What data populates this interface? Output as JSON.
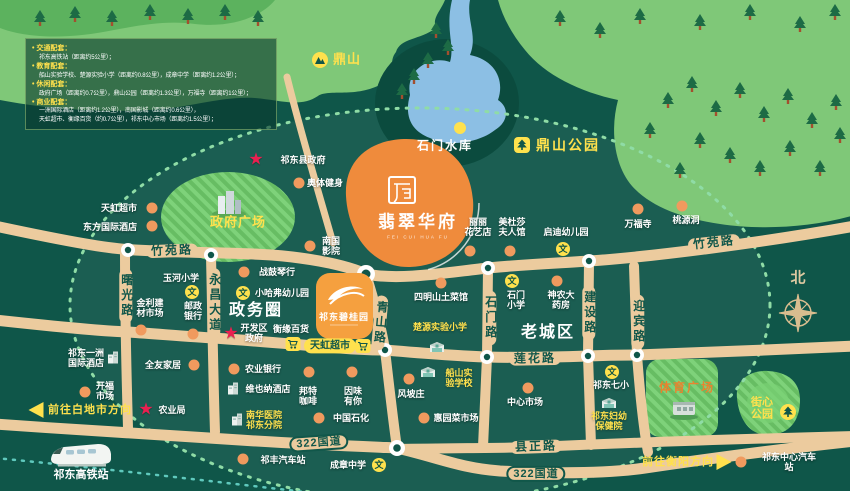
{
  "project": {
    "name": "翡翠华府",
    "pinyin": "FEI CUI HUA FU"
  },
  "compass": {
    "label": "北"
  },
  "colors": {
    "background": "#0f5649",
    "hill": "#7fc878",
    "road": "#eccb9e",
    "water": "#8cbfe4",
    "project_blob": "#ef8b3c",
    "brand_box": "#f5a03f",
    "accent_yellow": "#ffe14d",
    "star_red": "#ea2050",
    "poi_dot": "#f09a5e"
  },
  "legend": {
    "lines": [
      {
        "type": "h",
        "text": "交通配套："
      },
      {
        "type": "i",
        "text": "祁东高铁站（距离约5公里）；"
      },
      {
        "type": "h",
        "text": "教育配套："
      },
      {
        "type": "i",
        "text": "船山实验学校、楚源实验小学（距离约0.8公里），成章中学（距离约1.2公里）；"
      },
      {
        "type": "h",
        "text": "休闲配套："
      },
      {
        "type": "i",
        "text": "政府广场（距离约0.7公里），鼎山公园（距离约1.3公里），万福寺（距离约1公里）；"
      },
      {
        "type": "h",
        "text": "商业配套："
      },
      {
        "type": "i",
        "text": "一洲国际酒店（距离约1.2公里），南国影城（距离约0.6公里），"
      },
      {
        "type": "i",
        "text": "天虹超市、衡缘百货（约0.7公里），祁东中心市场（距离约1.5公里）；"
      }
    ]
  },
  "icons": {
    "wen_glyph": "文",
    "star_glyph": "★"
  },
  "map_labels": [
    {
      "name": "dingshan-hill",
      "t": "鼎山",
      "x": 347,
      "y": 60,
      "c": "yb13",
      "icon": "mountain",
      "ix": 320,
      "iy": 60
    },
    {
      "name": "shimen-reservoir",
      "t": "石门水库",
      "x": 445,
      "y": 146,
      "c": "wb12",
      "icon": "ydot",
      "ix": 460,
      "iy": 128
    },
    {
      "name": "dingshan-park",
      "t": "鼎山公园",
      "x": 568,
      "y": 146,
      "c": "yb14",
      "icon": "park",
      "ix": 522,
      "iy": 145
    },
    {
      "name": "qidong-county-gov",
      "t": "祁东县政府",
      "x": 303,
      "y": 160,
      "c": "w",
      "icon": "star",
      "ix": 256,
      "iy": 160
    },
    {
      "name": "aoti-fitness",
      "t": "奥体健身",
      "x": 325,
      "y": 183,
      "c": "w",
      "icon": "dot",
      "ix": 299,
      "iy": 183
    },
    {
      "name": "tianhong-market-west",
      "t": "天虹超市",
      "x": 119,
      "y": 208,
      "c": "w",
      "icon": "dot",
      "ix": 152,
      "iy": 208
    },
    {
      "name": "dongfang-intl-hotel",
      "t": "东方国际酒店",
      "x": 110,
      "y": 227,
      "c": "w",
      "icon": "dot",
      "ix": 152,
      "iy": 226
    },
    {
      "name": "zhengfu-square",
      "t": "政府广场",
      "x": 238,
      "y": 223,
      "c": "yb13"
    },
    {
      "name": "wanfu-temple",
      "t": "万福寺",
      "x": 638,
      "y": 224,
      "c": "w",
      "icon": "dot",
      "ix": 638,
      "iy": 209
    },
    {
      "name": "taoyuan-cave",
      "t": "桃源洞",
      "x": 686,
      "y": 220,
      "c": "w",
      "icon": "dot",
      "ix": 682,
      "iy": 206
    },
    {
      "name": "qidi-kindergarten",
      "t": "启迪幼儿园",
      "x": 566,
      "y": 232,
      "c": "w",
      "icon": "wen",
      "ix": 563,
      "iy": 249
    },
    {
      "name": "medusa-hall",
      "t": "美杜莎|夫人馆",
      "x": 512,
      "y": 227,
      "c": "w",
      "icon": "dot",
      "ix": 510,
      "iy": 251
    },
    {
      "name": "lili-flower-shop",
      "t": "丽丽|花艺店",
      "x": 478,
      "y": 227,
      "c": "w",
      "icon": "dot",
      "ix": 470,
      "iy": 251
    },
    {
      "name": "nanguo-cinema",
      "t": "南国|影院",
      "x": 331,
      "y": 246,
      "c": "w",
      "icon": "dot",
      "ix": 310,
      "iy": 246
    },
    {
      "name": "yuhe-primary-school",
      "t": "玉河小学",
      "x": 181,
      "y": 278,
      "c": "w",
      "icon": "wen",
      "ix": 192,
      "iy": 292
    },
    {
      "name": "zhangu-piano-shop",
      "t": "战鼓琴行",
      "x": 277,
      "y": 272,
      "c": "w",
      "icon": "dot",
      "ix": 244,
      "iy": 272
    },
    {
      "name": "harvard-kindergarten",
      "t": "小哈弗幼儿园",
      "x": 282,
      "y": 293,
      "c": "w",
      "icon": "wen",
      "ix": 243,
      "iy": 293
    },
    {
      "name": "zhengwu-circle",
      "t": "政务圈",
      "x": 256,
      "y": 311,
      "c": "big"
    },
    {
      "name": "jinli-materials-market",
      "t": "金利建|材市场",
      "x": 150,
      "y": 308,
      "c": "w",
      "icon": "dot",
      "ix": 141,
      "iy": 330
    },
    {
      "name": "postal-bank",
      "t": "邮政|银行",
      "x": 193,
      "y": 311,
      "c": "w",
      "icon": "dot",
      "ix": 193,
      "iy": 334
    },
    {
      "name": "kaifaqu-gov",
      "t": "开发区|政府",
      "x": 254,
      "y": 333,
      "c": "w",
      "icon": "star",
      "ix": 231,
      "iy": 334
    },
    {
      "name": "hengyuan-store",
      "t": "衡缘百货",
      "x": 291,
      "y": 329,
      "c": "w"
    },
    {
      "name": "tianhong-market-center",
      "t": "天虹超市",
      "x": 330,
      "y": 346,
      "c": "cap-y"
    },
    {
      "name": "cart-icon-left",
      "t": "",
      "icon": "cart",
      "ix": 293,
      "iy": 344
    },
    {
      "name": "cart-icon-right",
      "t": "",
      "icon": "cart",
      "ix": 363,
      "iy": 346
    },
    {
      "name": "bgy-project",
      "t": "祁东碧桂园",
      "x": 344,
      "y": 317,
      "c": "bgy"
    },
    {
      "name": "siming-restaurant",
      "t": "四明山土菜馆",
      "x": 441,
      "y": 297,
      "c": "w",
      "icon": "dot",
      "ix": 441,
      "iy": 283
    },
    {
      "name": "shimen-primary-school",
      "t": "石门|小学",
      "x": 516,
      "y": 300,
      "c": "w",
      "icon": "wen",
      "ix": 512,
      "iy": 281
    },
    {
      "name": "shennong-pharmacy",
      "t": "神农大|药房",
      "x": 561,
      "y": 300,
      "c": "w",
      "icon": "dot",
      "ix": 557,
      "iy": 281
    },
    {
      "name": "chuyuan-primary-school",
      "t": "楚源实验小学",
      "x": 440,
      "y": 327,
      "c": "y",
      "icon": "school",
      "ix": 437,
      "iy": 347
    },
    {
      "name": "laochengqu-area",
      "t": "老城区",
      "x": 548,
      "y": 333,
      "c": "big"
    },
    {
      "name": "yizhou-intl-hotel",
      "t": "祁东一洲|国际酒店",
      "x": 86,
      "y": 358,
      "c": "w",
      "icon": "bldg",
      "ix": 113,
      "iy": 357
    },
    {
      "name": "quanyou-home",
      "t": "全友家居",
      "x": 163,
      "y": 365,
      "c": "w",
      "icon": "dot",
      "ix": 194,
      "iy": 365
    },
    {
      "name": "chuanshan-school",
      "t": "船山实|验学校",
      "x": 459,
      "y": 378,
      "c": "y",
      "icon": "school",
      "ix": 428,
      "iy": 372
    },
    {
      "name": "agri-bank",
      "t": "农业银行",
      "x": 263,
      "y": 369,
      "c": "w",
      "icon": "dot",
      "ix": 234,
      "iy": 369
    },
    {
      "name": "kaifu-market",
      "t": "开福|市场",
      "x": 105,
      "y": 391,
      "c": "w",
      "icon": "dot",
      "ix": 85,
      "iy": 392
    },
    {
      "name": "agri-bureau",
      "t": "农业局",
      "x": 172,
      "y": 410,
      "c": "w",
      "icon": "star",
      "ix": 146,
      "iy": 410
    },
    {
      "name": "vienna-hotel",
      "t": "维也纳酒店",
      "x": 268,
      "y": 389,
      "c": "w",
      "icon": "bldg",
      "ix": 233,
      "iy": 388
    },
    {
      "name": "bangte-coffee",
      "t": "邦特|咖啡",
      "x": 308,
      "y": 396,
      "c": "w",
      "icon": "dot",
      "ix": 309,
      "iy": 372
    },
    {
      "name": "yinwei-cafe",
      "t": "因味|有你",
      "x": 353,
      "y": 396,
      "c": "w",
      "icon": "dot",
      "ix": 352,
      "iy": 372
    },
    {
      "name": "fengpo-village",
      "t": "风坡庄",
      "x": 411,
      "y": 394,
      "c": "w",
      "icon": "dot",
      "ix": 409,
      "iy": 379
    },
    {
      "name": "huiyuan-food-market",
      "t": "惠园菜市场",
      "x": 456,
      "y": 418,
      "c": "w",
      "icon": "dot",
      "ix": 424,
      "iy": 418
    },
    {
      "name": "sinopec",
      "t": "中国石化",
      "x": 351,
      "y": 418,
      "c": "w",
      "icon": "dot",
      "ix": 319,
      "iy": 418
    },
    {
      "name": "nanhua-hospital",
      "t": "南华医院|祁东分院",
      "x": 264,
      "y": 420,
      "c": "y",
      "icon": "bldg",
      "ix": 237,
      "iy": 419
    },
    {
      "name": "qifeng-bus-station",
      "t": "祁丰汽车站",
      "x": 283,
      "y": 460,
      "c": "w",
      "icon": "dot",
      "ix": 243,
      "iy": 459
    },
    {
      "name": "chengzhang-middle-school",
      "t": "成章中学",
      "x": 348,
      "y": 465,
      "c": "w",
      "icon": "wen",
      "ix": 379,
      "iy": 465
    },
    {
      "name": "center-market",
      "t": "中心市场",
      "x": 525,
      "y": 402,
      "c": "w",
      "icon": "dot",
      "ix": 528,
      "iy": 388
    },
    {
      "name": "qidong-7th-primary",
      "t": "祁东七小",
      "x": 611,
      "y": 385,
      "c": "w",
      "icon": "wen",
      "ix": 612,
      "iy": 372
    },
    {
      "name": "fuyou-health-hospital",
      "t": "祁东妇幼|保健院",
      "x": 609,
      "y": 421,
      "c": "y",
      "icon": "school",
      "ix": 609,
      "iy": 403
    },
    {
      "name": "sports-square",
      "t": "体育广场",
      "x": 687,
      "y": 388,
      "c": "ob12",
      "icon": "stadium",
      "ix": 684,
      "iy": 410
    },
    {
      "name": "jiexin-park",
      "t": "街心|公园",
      "x": 762,
      "y": 409,
      "c": "yb11",
      "icon": "treec",
      "ix": 788,
      "iy": 412
    },
    {
      "name": "qidong-central-bus-station",
      "t": "祁东中心汽车站",
      "x": 789,
      "y": 462,
      "c": "w",
      "icon": "dot",
      "ix": 741,
      "iy": 462
    },
    {
      "name": "qidong-hsr-station",
      "t": "祁东高铁站",
      "x": 81,
      "y": 475,
      "c": "wb11",
      "icon": "train",
      "ix": 81,
      "iy": 455
    }
  ],
  "road_labels": [
    {
      "name": "zhuyuan-road-west",
      "t": "竹苑路",
      "x": 172,
      "y": 251,
      "rot": -2
    },
    {
      "name": "zhuyuan-road-east",
      "t": "竹苑路",
      "x": 714,
      "y": 243,
      "rot": -6
    },
    {
      "name": "lianhua-road",
      "t": "莲花路",
      "x": 535,
      "y": 359,
      "rot": -1
    },
    {
      "name": "xianzheng-road",
      "t": "县正路",
      "x": 536,
      "y": 447,
      "rot": -2
    },
    {
      "name": "g322-west",
      "t": "322国道",
      "x": 319,
      "y": 443,
      "rot": -4,
      "capsule": true
    },
    {
      "name": "g322-east",
      "t": "322国道",
      "x": 536,
      "y": 474,
      "rot": 0,
      "capsule": true
    },
    {
      "name": "shuguang-road",
      "t": "曙光路",
      "x": 126,
      "y": 296,
      "vertical": true
    },
    {
      "name": "yongchang-avenue",
      "t": "永昌大道",
      "x": 214,
      "y": 303,
      "vertical": true
    },
    {
      "name": "qingshan-road",
      "t": "青山路",
      "x": 380,
      "y": 323,
      "vertical": true,
      "rot": 5
    },
    {
      "name": "shimen-road",
      "t": "石门路",
      "x": 490,
      "y": 318,
      "vertical": true
    },
    {
      "name": "jianshe-road",
      "t": "建设路",
      "x": 589,
      "y": 313,
      "vertical": true
    },
    {
      "name": "yingbin-road",
      "t": "迎宾路",
      "x": 638,
      "y": 322,
      "vertical": true
    }
  ],
  "directions": [
    {
      "name": "dir-baidishi",
      "t": "前往白地市方向",
      "x": 90,
      "y": 410,
      "arrow": "left",
      "ax": 36,
      "ay": 410
    },
    {
      "name": "dir-hengyang",
      "t": "前往衡阳方向",
      "x": 678,
      "y": 462,
      "arrow": "right",
      "ax": 724,
      "ay": 462
    }
  ]
}
